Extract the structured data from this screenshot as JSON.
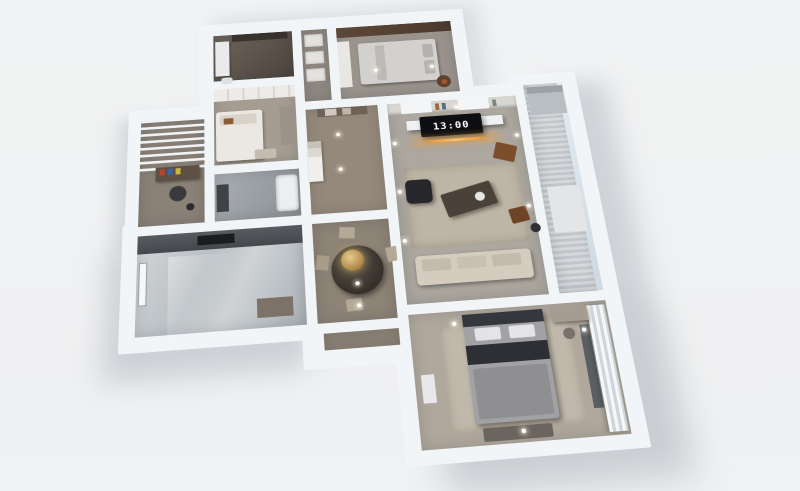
{
  "scene": {
    "type": "3d-apartment-floor-plan-render",
    "background_color": "#f0f1f2",
    "wall_color": "#f2f5f8",
    "accent_light_color": "#f0a040",
    "clock": {
      "time": "13:00"
    },
    "rooms": [
      {
        "id": "bathroom-top",
        "label": "bathroom",
        "floor_color": "#5c5249"
      },
      {
        "id": "hall-closet",
        "label": "hallway closet",
        "floor_color": "#8f8880"
      },
      {
        "id": "bedroom-3",
        "label": "bedroom with silver bedding",
        "floor_color": "#99938c"
      },
      {
        "id": "bedroom-2",
        "label": "bedroom with white bed and wardrobe",
        "floor_color": "#a69d92"
      },
      {
        "id": "study-balcony",
        "label": "study balcony with louvered pergola and desk",
        "floor_color": "#8a8177"
      },
      {
        "id": "bathroom-main",
        "label": "main bathroom",
        "floor_color": "#9a9fa3"
      },
      {
        "id": "foyer",
        "label": "entry foyer with shelving cabinet",
        "floor_color": "#95897b"
      },
      {
        "id": "kitchen",
        "label": "kitchen with dark counters and glossy floor",
        "floor_color": "#bec3c7"
      },
      {
        "id": "dining-area",
        "label": "dining area with round table and gold pendant",
        "floor_color": "#8d8376"
      },
      {
        "id": "south-corridor",
        "label": "corridor to master bedroom",
        "floor_color": "#8d8376"
      },
      {
        "id": "living-room",
        "label": "living room with TV wall, rug and sofa",
        "floor_color": "#aca79f"
      },
      {
        "id": "east-balcony",
        "label": "glazed east balcony with slatted floor",
        "floor_color": "#cdd1d4"
      },
      {
        "id": "master-bedroom",
        "label": "master bedroom with gray bed and curtains",
        "floor_color": "#b0a89d"
      }
    ],
    "furniture_highlights": [
      "tv-with-digital-clock",
      "amber-light-strip",
      "bookshelf-wall",
      "beige-sofa",
      "black-armchair",
      "dark-coffee-table",
      "round-dining-table",
      "gold-pendant-lamp",
      "office-desk-with-books",
      "office-chair",
      "double-beds",
      "wardrobes",
      "kitchen-counter-with-cooktop",
      "sheer-curtains",
      "ceiling-downlights"
    ]
  }
}
